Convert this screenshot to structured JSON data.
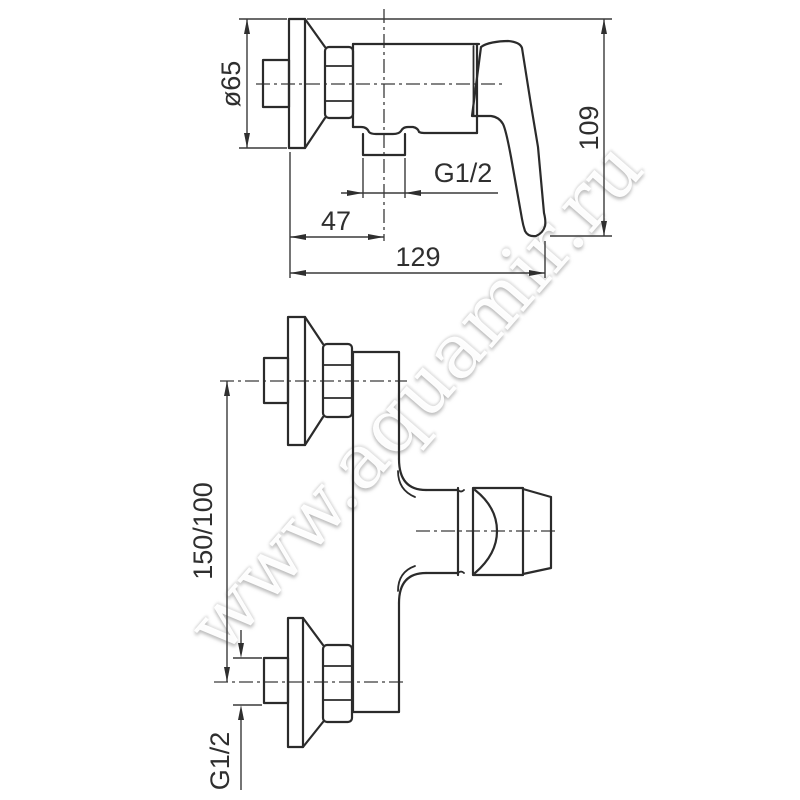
{
  "drawing_type": "faucet technical dimension drawing",
  "watermark": {
    "text": "www.aquamir.ru"
  },
  "side_view": {
    "name": "side view of wall-mounted shower mixer",
    "dims": {
      "flange_diameter": "ø65",
      "overall_height": "109",
      "outlet_thread": "G1/2",
      "wall_to_axis": "47",
      "overall_width": "129"
    }
  },
  "front_view": {
    "name": "front view of wall-mounted shower mixer",
    "dims": {
      "connection_spacing": "150/100",
      "inlet_thread": "G1/2"
    }
  },
  "colors": {
    "background": "#ffffff",
    "outline": "#2b2b2b",
    "dimension": "#3a3a3a",
    "watermark": "#f2f2f2"
  }
}
